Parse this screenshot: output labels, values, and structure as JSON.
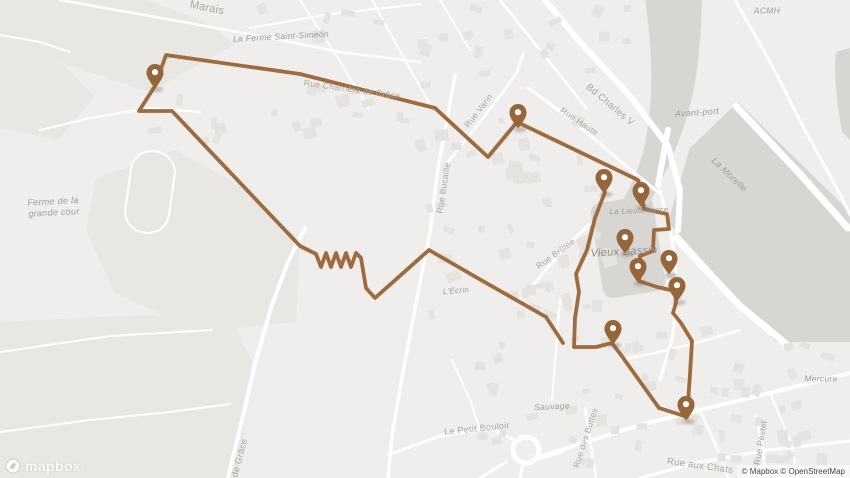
{
  "branding": {
    "logo_text": "mapbox",
    "attribution": "© Mapbox © OpenStreetMap"
  },
  "map": {
    "colors": {
      "background": "#efeeec",
      "field": "#e9e7e4",
      "water": "#d8d6d3",
      "building": "#e5e3e0",
      "road": "#ffffff",
      "route": "#9e6b3e",
      "marker": "#96663a",
      "marker_hole": "#ffffff",
      "road_label": "#a9a69f",
      "place_label": "#a09d97",
      "big_place_label": "#8f8c86"
    },
    "fields": [
      [
        [
          0,
          0
        ],
        [
          148,
          0
        ],
        [
          205,
          22
        ],
        [
          235,
          44
        ],
        [
          150,
          92
        ],
        [
          60,
          62
        ],
        [
          0,
          48
        ]
      ],
      [
        [
          0,
          48
        ],
        [
          60,
          62
        ],
        [
          95,
          96
        ],
        [
          58,
          140
        ],
        [
          0,
          128
        ]
      ],
      [
        [
          96,
          178
        ],
        [
          176,
          150
        ],
        [
          242,
          186
        ],
        [
          300,
          240
        ],
        [
          296,
          322
        ],
        [
          198,
          332
        ],
        [
          114,
          292
        ],
        [
          86,
          230
        ]
      ],
      [
        [
          0,
          322
        ],
        [
          120,
          316
        ],
        [
          230,
          314
        ],
        [
          252,
          362
        ],
        [
          238,
          478
        ],
        [
          0,
          478
        ]
      ]
    ],
    "water_paths": [
      "M645,0 C652,44 654,92 647,132 C643,160 634,180 624,198 L644,212 C663,180 676,152 686,120 C697,86 701,44 702,0 Z",
      "M668,222 L690,148 L738,102 L850,212 L850,342 L776,342 Z",
      "M836,52 L850,48 L850,140 L842,132 C836,100 834,74 836,52 Z"
    ],
    "basin": {
      "cx": 628,
      "cy": 247,
      "w": 63,
      "h": 96,
      "rx": 10,
      "rot": -9
    },
    "stadium": {
      "cx": 150,
      "cy": 192,
      "w": 44,
      "h": 82,
      "rx": 21,
      "rot": 8
    },
    "roundabout": {
      "cx": 526,
      "cy": 450,
      "r": 13
    },
    "roads": [
      {
        "p": [
          [
            60,
            0
          ],
          [
            150,
            16
          ],
          [
            260,
            36
          ],
          [
            340,
            52
          ],
          [
            420,
            62
          ]
        ],
        "w": 2.5
      },
      {
        "p": [
          [
            545,
            0
          ],
          [
            580,
            42
          ],
          [
            630,
            96
          ],
          [
            668,
            146
          ],
          [
            680,
            190
          ],
          [
            678,
            230
          ]
        ],
        "w": 6
      },
      {
        "p": [
          [
            735,
            0
          ],
          [
            768,
            58
          ],
          [
            806,
            132
          ],
          [
            842,
            198
          ],
          [
            850,
            215
          ]
        ],
        "w": 3
      },
      {
        "p": [
          [
            528,
            88
          ],
          [
            572,
            120
          ],
          [
            626,
            166
          ],
          [
            658,
            192
          ]
        ],
        "w": 3
      },
      {
        "p": [
          [
            448,
            162
          ],
          [
            472,
            132
          ],
          [
            497,
            100
          ],
          [
            516,
            74
          ],
          [
            524,
            52
          ]
        ],
        "w": 2.5
      },
      {
        "p": [
          [
            455,
            75
          ],
          [
            447,
            120
          ],
          [
            438,
            168
          ],
          [
            430,
            232
          ],
          [
            417,
            298
          ],
          [
            403,
            372
          ],
          [
            392,
            436
          ],
          [
            388,
            478
          ]
        ],
        "w": 3.5
      },
      {
        "p": [
          [
            228,
            478
          ],
          [
            242,
            420
          ],
          [
            256,
            360
          ],
          [
            272,
            305
          ],
          [
            288,
            262
          ],
          [
            305,
            228
          ]
        ],
        "w": 4
      },
      {
        "p": [
          [
            0,
            432
          ],
          [
            90,
            420
          ],
          [
            170,
            412
          ],
          [
            230,
            404
          ]
        ],
        "w": 2
      },
      {
        "p": [
          [
            0,
            352
          ],
          [
            110,
            336
          ],
          [
            212,
            330
          ]
        ],
        "w": 2
      },
      {
        "p": [
          [
            388,
            455
          ],
          [
            440,
            436
          ],
          [
            490,
            428
          ],
          [
            514,
            440
          ]
        ],
        "w": 3
      },
      {
        "p": [
          [
            536,
            458
          ],
          [
            580,
            444
          ],
          [
            640,
            425
          ],
          [
            700,
            410
          ],
          [
            770,
            393
          ],
          [
            850,
            373
          ]
        ],
        "w": 4
      },
      {
        "p": [
          [
            640,
            478
          ],
          [
            700,
            462
          ],
          [
            768,
            450
          ],
          [
            850,
            441
          ]
        ],
        "w": 3
      },
      {
        "p": [
          [
            480,
            478
          ],
          [
            506,
            462
          ]
        ],
        "w": 3
      },
      {
        "p": [
          [
            520,
            478
          ],
          [
            523,
            464
          ]
        ],
        "w": 3
      },
      {
        "p": [
          [
            538,
            459
          ],
          [
            562,
            452
          ]
        ],
        "w": 3
      },
      {
        "p": [
          [
            585,
            408
          ],
          [
            591,
            445
          ],
          [
            596,
            478
          ]
        ],
        "w": 2.5
      },
      {
        "p": [
          [
            756,
            415
          ],
          [
            763,
            448
          ],
          [
            766,
            478
          ]
        ],
        "w": 2.5
      },
      {
        "p": [
          [
            518,
            302
          ],
          [
            544,
            272
          ],
          [
            566,
            246
          ],
          [
            590,
            224
          ]
        ],
        "w": 3
      },
      {
        "p": [
          [
            660,
            190
          ],
          [
            672,
            240
          ],
          [
            678,
            290
          ],
          [
            672,
            340
          ],
          [
            660,
            380
          ]
        ],
        "w": 3
      },
      {
        "p": [
          [
            250,
            28
          ],
          [
            330,
            14
          ],
          [
            420,
            4
          ]
        ],
        "w": 2
      },
      {
        "p": [
          [
            300,
            0
          ],
          [
            338,
            58
          ],
          [
            368,
            108
          ]
        ],
        "w": 2
      },
      {
        "p": [
          [
            372,
            0
          ],
          [
            406,
            62
          ],
          [
            430,
            104
          ]
        ],
        "w": 2
      },
      {
        "p": [
          [
            440,
            0
          ],
          [
            470,
            50
          ]
        ],
        "w": 2
      },
      {
        "p": [
          [
            500,
            0
          ],
          [
            548,
            60
          ],
          [
            586,
            108
          ]
        ],
        "w": 2.5
      },
      {
        "p": [
          [
            0,
            35
          ],
          [
            40,
            42
          ],
          [
            70,
            52
          ]
        ],
        "w": 2
      },
      {
        "p": [
          [
            40,
            130
          ],
          [
            90,
            118
          ],
          [
            150,
            108
          ],
          [
            200,
            112
          ]
        ],
        "w": 2
      },
      {
        "p": [
          [
            452,
            360
          ],
          [
            470,
            400
          ],
          [
            480,
            430
          ]
        ],
        "w": 2
      },
      {
        "p": [
          [
            560,
            300
          ],
          [
            556,
            350
          ],
          [
            552,
            400
          ]
        ],
        "w": 2
      },
      {
        "p": [
          [
            620,
            360
          ],
          [
            660,
            352
          ],
          [
            700,
            342
          ],
          [
            740,
            330
          ]
        ],
        "w": 2.5
      },
      {
        "p": [
          [
            700,
            410
          ],
          [
            720,
            455
          ],
          [
            728,
            478
          ]
        ],
        "w": 2.5
      },
      {
        "p": [
          [
            770,
            393
          ],
          [
            790,
            440
          ],
          [
            798,
            478
          ]
        ],
        "w": 2
      },
      {
        "p": [
          [
            736,
            106
          ],
          [
            800,
            174
          ],
          [
            848,
            228
          ]
        ],
        "w": 7
      },
      {
        "p": [
          [
            676,
            238
          ],
          [
            740,
            306
          ],
          [
            786,
            344
          ]
        ],
        "w": 7
      },
      {
        "p": [
          [
            668,
            130
          ],
          [
            658,
            185
          ]
        ],
        "w": 6
      }
    ],
    "building_regions": [
      {
        "x": 250,
        "y": 0,
        "w": 380,
        "h": 148,
        "n": 42
      },
      {
        "x": 420,
        "y": 152,
        "w": 190,
        "h": 165,
        "n": 34
      },
      {
        "x": 500,
        "y": 160,
        "w": 95,
        "h": 150,
        "n": 16
      },
      {
        "x": 480,
        "y": 330,
        "w": 330,
        "h": 145,
        "n": 40
      },
      {
        "x": 600,
        "y": 340,
        "w": 240,
        "h": 130,
        "n": 22
      },
      {
        "x": 120,
        "y": 90,
        "w": 120,
        "h": 55,
        "n": 6
      }
    ],
    "route": {
      "chains": [
        [
          [
            563,
            343
          ],
          [
            546,
            317
          ],
          [
            481,
            280
          ],
          [
            429,
            250
          ],
          [
            375,
            298
          ],
          [
            366,
            288
          ],
          [
            361,
            258
          ],
          [
            356,
            253
          ],
          [
            351,
            267
          ],
          [
            346,
            253
          ],
          [
            341,
            267
          ],
          [
            336,
            253
          ],
          [
            331,
            267
          ],
          [
            326,
            253
          ],
          [
            321,
            267
          ],
          [
            316,
            254
          ],
          [
            300,
            246
          ],
          [
            172,
            111
          ],
          [
            139,
            111
          ],
          [
            155,
            86
          ],
          [
            166,
            55
          ],
          [
            300,
            74
          ],
          [
            435,
            108
          ],
          [
            488,
            157
          ],
          [
            517,
            122
          ],
          [
            638,
            180
          ],
          [
            642,
            196
          ],
          [
            644,
            209
          ],
          [
            667,
            214
          ],
          [
            669,
            229
          ],
          [
            654,
            230
          ],
          [
            653,
            251
          ],
          [
            640,
            256
          ],
          [
            639,
            281
          ],
          [
            657,
            287
          ],
          [
            675,
            291
          ],
          [
            676,
            303
          ],
          [
            673,
            313
          ],
          [
            681,
            323
          ],
          [
            692,
            341
          ],
          [
            690,
            374
          ],
          [
            688,
            403
          ]
        ],
        [
          [
            605,
            192
          ],
          [
            595,
            218
          ],
          [
            587,
            250
          ],
          [
            576,
            274
          ],
          [
            579,
            292
          ],
          [
            575,
            318
          ],
          [
            574,
            347
          ],
          [
            596,
            347
          ],
          [
            612,
            343
          ],
          [
            621,
            355
          ],
          [
            659,
            408
          ],
          [
            678,
            414
          ],
          [
            687,
            417
          ]
        ]
      ]
    },
    "markers": [
      {
        "x": 155,
        "y": 73
      },
      {
        "x": 518,
        "y": 113
      },
      {
        "x": 604,
        "y": 178
      },
      {
        "x": 641,
        "y": 191
      },
      {
        "x": 625,
        "y": 238
      },
      {
        "x": 669,
        "y": 259
      },
      {
        "x": 638,
        "y": 267
      },
      {
        "x": 677,
        "y": 286
      },
      {
        "x": 613,
        "y": 329
      },
      {
        "x": 686,
        "y": 405
      }
    ],
    "labels": [
      {
        "t": "Marais",
        "x": 207,
        "y": 8,
        "r": 12,
        "s": 11,
        "i": false
      },
      {
        "t": "La Ferme Saint-Simeon",
        "x": 281,
        "y": 37,
        "r": -3,
        "s": 8.5,
        "i": true
      },
      {
        "t": "Rue Charrière de Grâce",
        "x": 352,
        "y": 90,
        "r": 8,
        "s": 8.5,
        "i": false
      },
      {
        "t": "Rue Varin",
        "x": 479,
        "y": 111,
        "r": -52,
        "s": 8.5,
        "i": false
      },
      {
        "t": "Bd Charles V",
        "x": 610,
        "y": 105,
        "r": 40,
        "s": 9.5,
        "i": false
      },
      {
        "t": "Rue Haute",
        "x": 579,
        "y": 122,
        "r": 34,
        "s": 8.5,
        "i": false
      },
      {
        "t": "ACMH",
        "x": 767,
        "y": 11,
        "r": 0,
        "s": 8.5,
        "i": true
      },
      {
        "t": "Avant-port",
        "x": 697,
        "y": 113,
        "r": -4,
        "s": 9,
        "i": true
      },
      {
        "t": "La Morelle",
        "x": 729,
        "y": 175,
        "r": 44,
        "s": 9,
        "i": true
      },
      {
        "t": "Ferme de la",
        "x": 53,
        "y": 202,
        "r": -3,
        "s": 9,
        "i": true
      },
      {
        "t": "grande cour",
        "x": 54,
        "y": 213,
        "r": -3,
        "s": 9,
        "i": true
      },
      {
        "t": "Rue Bucaille",
        "x": 444,
        "y": 188,
        "r": -81,
        "s": 8.5,
        "i": false
      },
      {
        "t": "Rue Brûlée",
        "x": 556,
        "y": 254,
        "r": -36,
        "s": 8.5,
        "i": false
      },
      {
        "t": "L'Ecrin",
        "x": 456,
        "y": 291,
        "r": -5,
        "s": 8,
        "i": true
      },
      {
        "t": "Vieux Bassin",
        "x": 624,
        "y": 252,
        "r": -3,
        "s": 11,
        "i": true,
        "big": true
      },
      {
        "t": "La Lieutenance",
        "x": 639,
        "y": 211,
        "r": -2,
        "s": 8,
        "i": true
      },
      {
        "t": "de Grâce",
        "x": 240,
        "y": 458,
        "r": -75,
        "s": 9,
        "i": false
      },
      {
        "t": "Sauvage",
        "x": 552,
        "y": 407,
        "r": -3,
        "s": 8.5,
        "i": true
      },
      {
        "t": "Le Petit Bouloir",
        "x": 477,
        "y": 429,
        "r": -6,
        "s": 9,
        "i": false
      },
      {
        "t": "Rue des Buttes",
        "x": 586,
        "y": 438,
        "r": -72,
        "s": 8.5,
        "i": false
      },
      {
        "t": "Rue aux Chats",
        "x": 700,
        "y": 466,
        "r": 8,
        "s": 9.5,
        "i": false
      },
      {
        "t": "Rue Pestel",
        "x": 761,
        "y": 443,
        "r": -80,
        "s": 8.5,
        "i": false
      },
      {
        "t": "Mercure",
        "x": 821,
        "y": 379,
        "r": 0,
        "s": 8.5,
        "i": true
      }
    ]
  }
}
